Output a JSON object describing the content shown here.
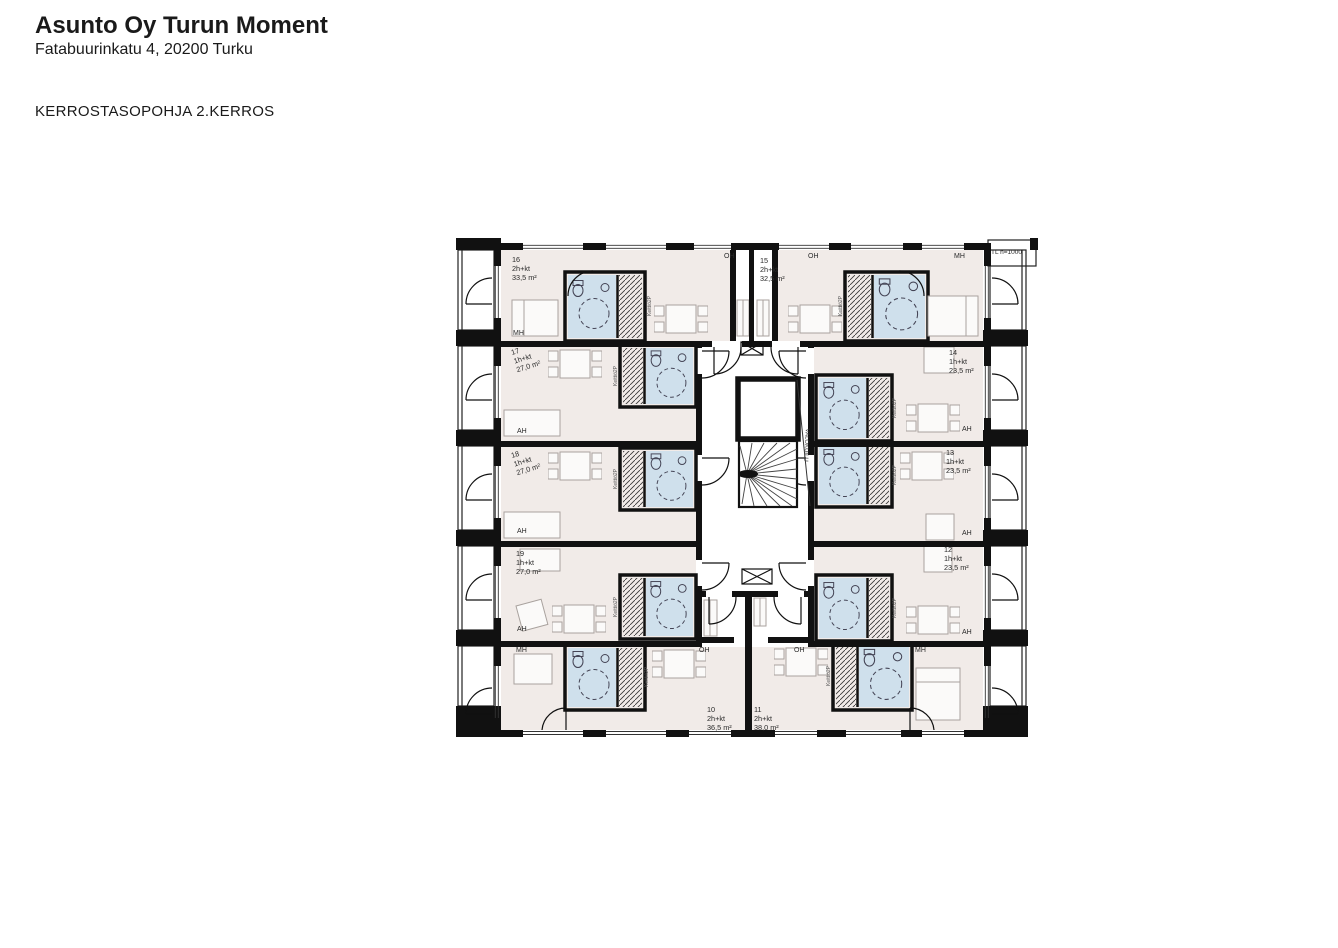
{
  "header": {
    "title": "Asunto Oy Turun Moment",
    "address": "Fatabuurinkatu 4, 20200 Turku",
    "drawing_title": "KERROSTASOPOHJA 2.KERROS"
  },
  "plan": {
    "note_top_right": "TL h=1000",
    "light_well": "VALOKUILU",
    "kitchen_unit": "Keittiö2P",
    "apartments": [
      {
        "number": "10",
        "type": "2h+kt",
        "area": "36,5 m²",
        "rooms": [
          "MH",
          "OH"
        ]
      },
      {
        "number": "11",
        "type": "2h+kt",
        "area": "38,0 m²",
        "rooms": [
          "OH",
          "MH"
        ]
      },
      {
        "number": "12",
        "type": "1h+kt",
        "area": "23,5 m²",
        "rooms": [
          "AH"
        ]
      },
      {
        "number": "13",
        "type": "1h+kt",
        "area": "23,5 m²",
        "rooms": [
          "AH"
        ]
      },
      {
        "number": "14",
        "type": "1h+kt",
        "area": "23,5 m²",
        "rooms": [
          "AH"
        ]
      },
      {
        "number": "15",
        "type": "2h+kt",
        "area": "32,5 m²",
        "rooms": [
          "OH",
          "MH"
        ]
      },
      {
        "number": "16",
        "type": "2h+kt",
        "area": "33,5 m²",
        "rooms": [
          "OH",
          "MH"
        ]
      },
      {
        "number": "17",
        "type": "1h+kt",
        "area": "27,0 m²",
        "rooms": [
          "AH"
        ]
      },
      {
        "number": "18",
        "type": "1h+kt",
        "area": "27,0 m²",
        "rooms": [
          "AH"
        ]
      },
      {
        "number": "19",
        "type": "1h+kt",
        "area": "27,0 m²",
        "rooms": [
          "AH"
        ]
      }
    ],
    "colors": {
      "wall": "#111111",
      "floor": "#f1ebe8",
      "wet_room": "#cfe0ec",
      "line": "#333333"
    }
  }
}
